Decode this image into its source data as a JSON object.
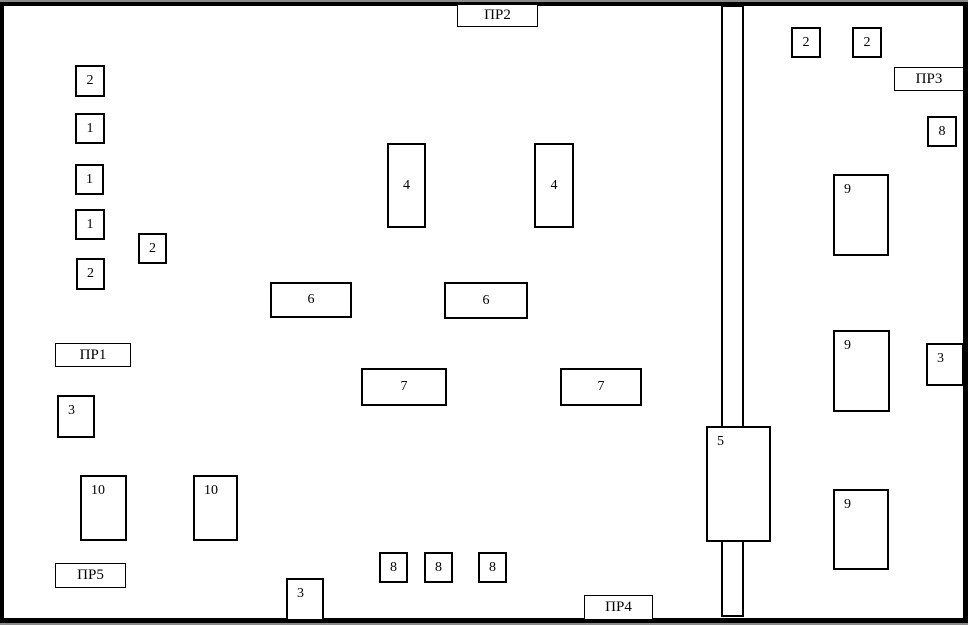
{
  "plan": {
    "colors": {
      "line": "#000000",
      "background": "#ffffff",
      "edge_shadow": "#8a8a8a"
    },
    "boxes": [
      {
        "text": "2",
        "x": 75,
        "y": 65,
        "w": 30,
        "h": 32,
        "align": "center"
      },
      {
        "text": "1",
        "x": 75,
        "y": 113,
        "w": 30,
        "h": 31,
        "align": "center"
      },
      {
        "text": "1",
        "x": 75,
        "y": 164,
        "w": 29,
        "h": 31,
        "align": "center"
      },
      {
        "text": "1",
        "x": 75,
        "y": 209,
        "w": 30,
        "h": 31,
        "align": "center"
      },
      {
        "text": "2",
        "x": 76,
        "y": 258,
        "w": 29,
        "h": 32,
        "align": "center"
      },
      {
        "text": "2",
        "x": 138,
        "y": 233,
        "w": 29,
        "h": 31,
        "align": "center"
      },
      {
        "text": "4",
        "x": 387,
        "y": 143,
        "w": 39,
        "h": 85,
        "align": "center"
      },
      {
        "text": "4",
        "x": 534,
        "y": 143,
        "w": 40,
        "h": 85,
        "align": "center"
      },
      {
        "text": "2",
        "x": 791,
        "y": 27,
        "w": 30,
        "h": 31,
        "align": "center"
      },
      {
        "text": "2",
        "x": 852,
        "y": 27,
        "w": 30,
        "h": 31,
        "align": "center"
      },
      {
        "text": "8",
        "x": 927,
        "y": 116,
        "w": 30,
        "h": 31,
        "align": "center"
      },
      {
        "text": "9",
        "x": 833,
        "y": 174,
        "w": 56,
        "h": 82,
        "align": "topleft"
      },
      {
        "text": "9",
        "x": 833,
        "y": 330,
        "w": 57,
        "h": 82,
        "align": "topleft"
      },
      {
        "text": "9",
        "x": 833,
        "y": 489,
        "w": 56,
        "h": 81,
        "align": "topleft"
      },
      {
        "text": "3",
        "x": 926,
        "y": 343,
        "w": 38,
        "h": 43,
        "align": "topleft"
      },
      {
        "text": "6",
        "x": 270,
        "y": 282,
        "w": 82,
        "h": 36,
        "align": "center"
      },
      {
        "text": "6",
        "x": 444,
        "y": 282,
        "w": 84,
        "h": 37,
        "align": "center"
      },
      {
        "text": "7",
        "x": 361,
        "y": 368,
        "w": 86,
        "h": 38,
        "align": "center"
      },
      {
        "text": "7",
        "x": 560,
        "y": 368,
        "w": 82,
        "h": 38,
        "align": "center"
      },
      {
        "text": "3",
        "x": 57,
        "y": 395,
        "w": 38,
        "h": 43,
        "align": "topleft"
      },
      {
        "text": "10",
        "x": 80,
        "y": 475,
        "w": 47,
        "h": 66,
        "align": "topleft"
      },
      {
        "text": "10",
        "x": 193,
        "y": 475,
        "w": 45,
        "h": 66,
        "align": "topleft"
      },
      {
        "text": "3",
        "x": 286,
        "y": 578,
        "w": 38,
        "h": 43,
        "align": "topleft"
      },
      {
        "text": "8",
        "x": 379,
        "y": 552,
        "w": 29,
        "h": 31,
        "align": "center"
      },
      {
        "text": "8",
        "x": 424,
        "y": 552,
        "w": 29,
        "h": 31,
        "align": "center"
      },
      {
        "text": "8",
        "x": 478,
        "y": 552,
        "w": 29,
        "h": 31,
        "align": "center"
      },
      {
        "text": "5",
        "x": 706,
        "y": 426,
        "w": 65,
        "h": 116,
        "align": "topleft"
      }
    ],
    "labels": [
      {
        "id": "pr1",
        "text": "ПР1",
        "x": 55,
        "y": 343,
        "w": 76,
        "h": 24
      },
      {
        "id": "pr2",
        "text": "ПР2",
        "x": 457,
        "y": 4,
        "w": 81,
        "h": 23
      },
      {
        "id": "pr3",
        "text": "ПР3",
        "x": 894,
        "y": 67,
        "w": 70,
        "h": 24
      },
      {
        "id": "pr4",
        "text": "ПР4",
        "x": 584,
        "y": 595,
        "w": 69,
        "h": 25
      },
      {
        "id": "pr5",
        "text": "ПР5",
        "x": 55,
        "y": 563,
        "w": 71,
        "h": 25
      }
    ],
    "shaft": {
      "left_line_x": 721,
      "right_line_x": 742,
      "line_width": 2,
      "outer_width": 23,
      "upper_top": 6,
      "upper_bottom": 426,
      "lower_top": 542,
      "lower_bottom": 617,
      "top_cap_y": 2,
      "top_cap_h": 5,
      "bottom_cap_y": 615,
      "bottom_cap_h": 2
    },
    "border": {
      "top": {
        "x": 0,
        "y": 2,
        "w": 968,
        "h": 4
      },
      "left": {
        "x": 0,
        "y": 2,
        "w": 4,
        "h": 621
      },
      "right": {
        "x": 963,
        "y": 2,
        "w": 5,
        "h": 621
      },
      "bottom": {
        "x": 0,
        "y": 618,
        "w": 968,
        "h": 5
      },
      "shadow_top": {
        "x": 0,
        "y": 0,
        "w": 968,
        "h": 2
      },
      "shadow_bottom": {
        "x": 0,
        "y": 623,
        "w": 968,
        "h": 2
      }
    }
  }
}
